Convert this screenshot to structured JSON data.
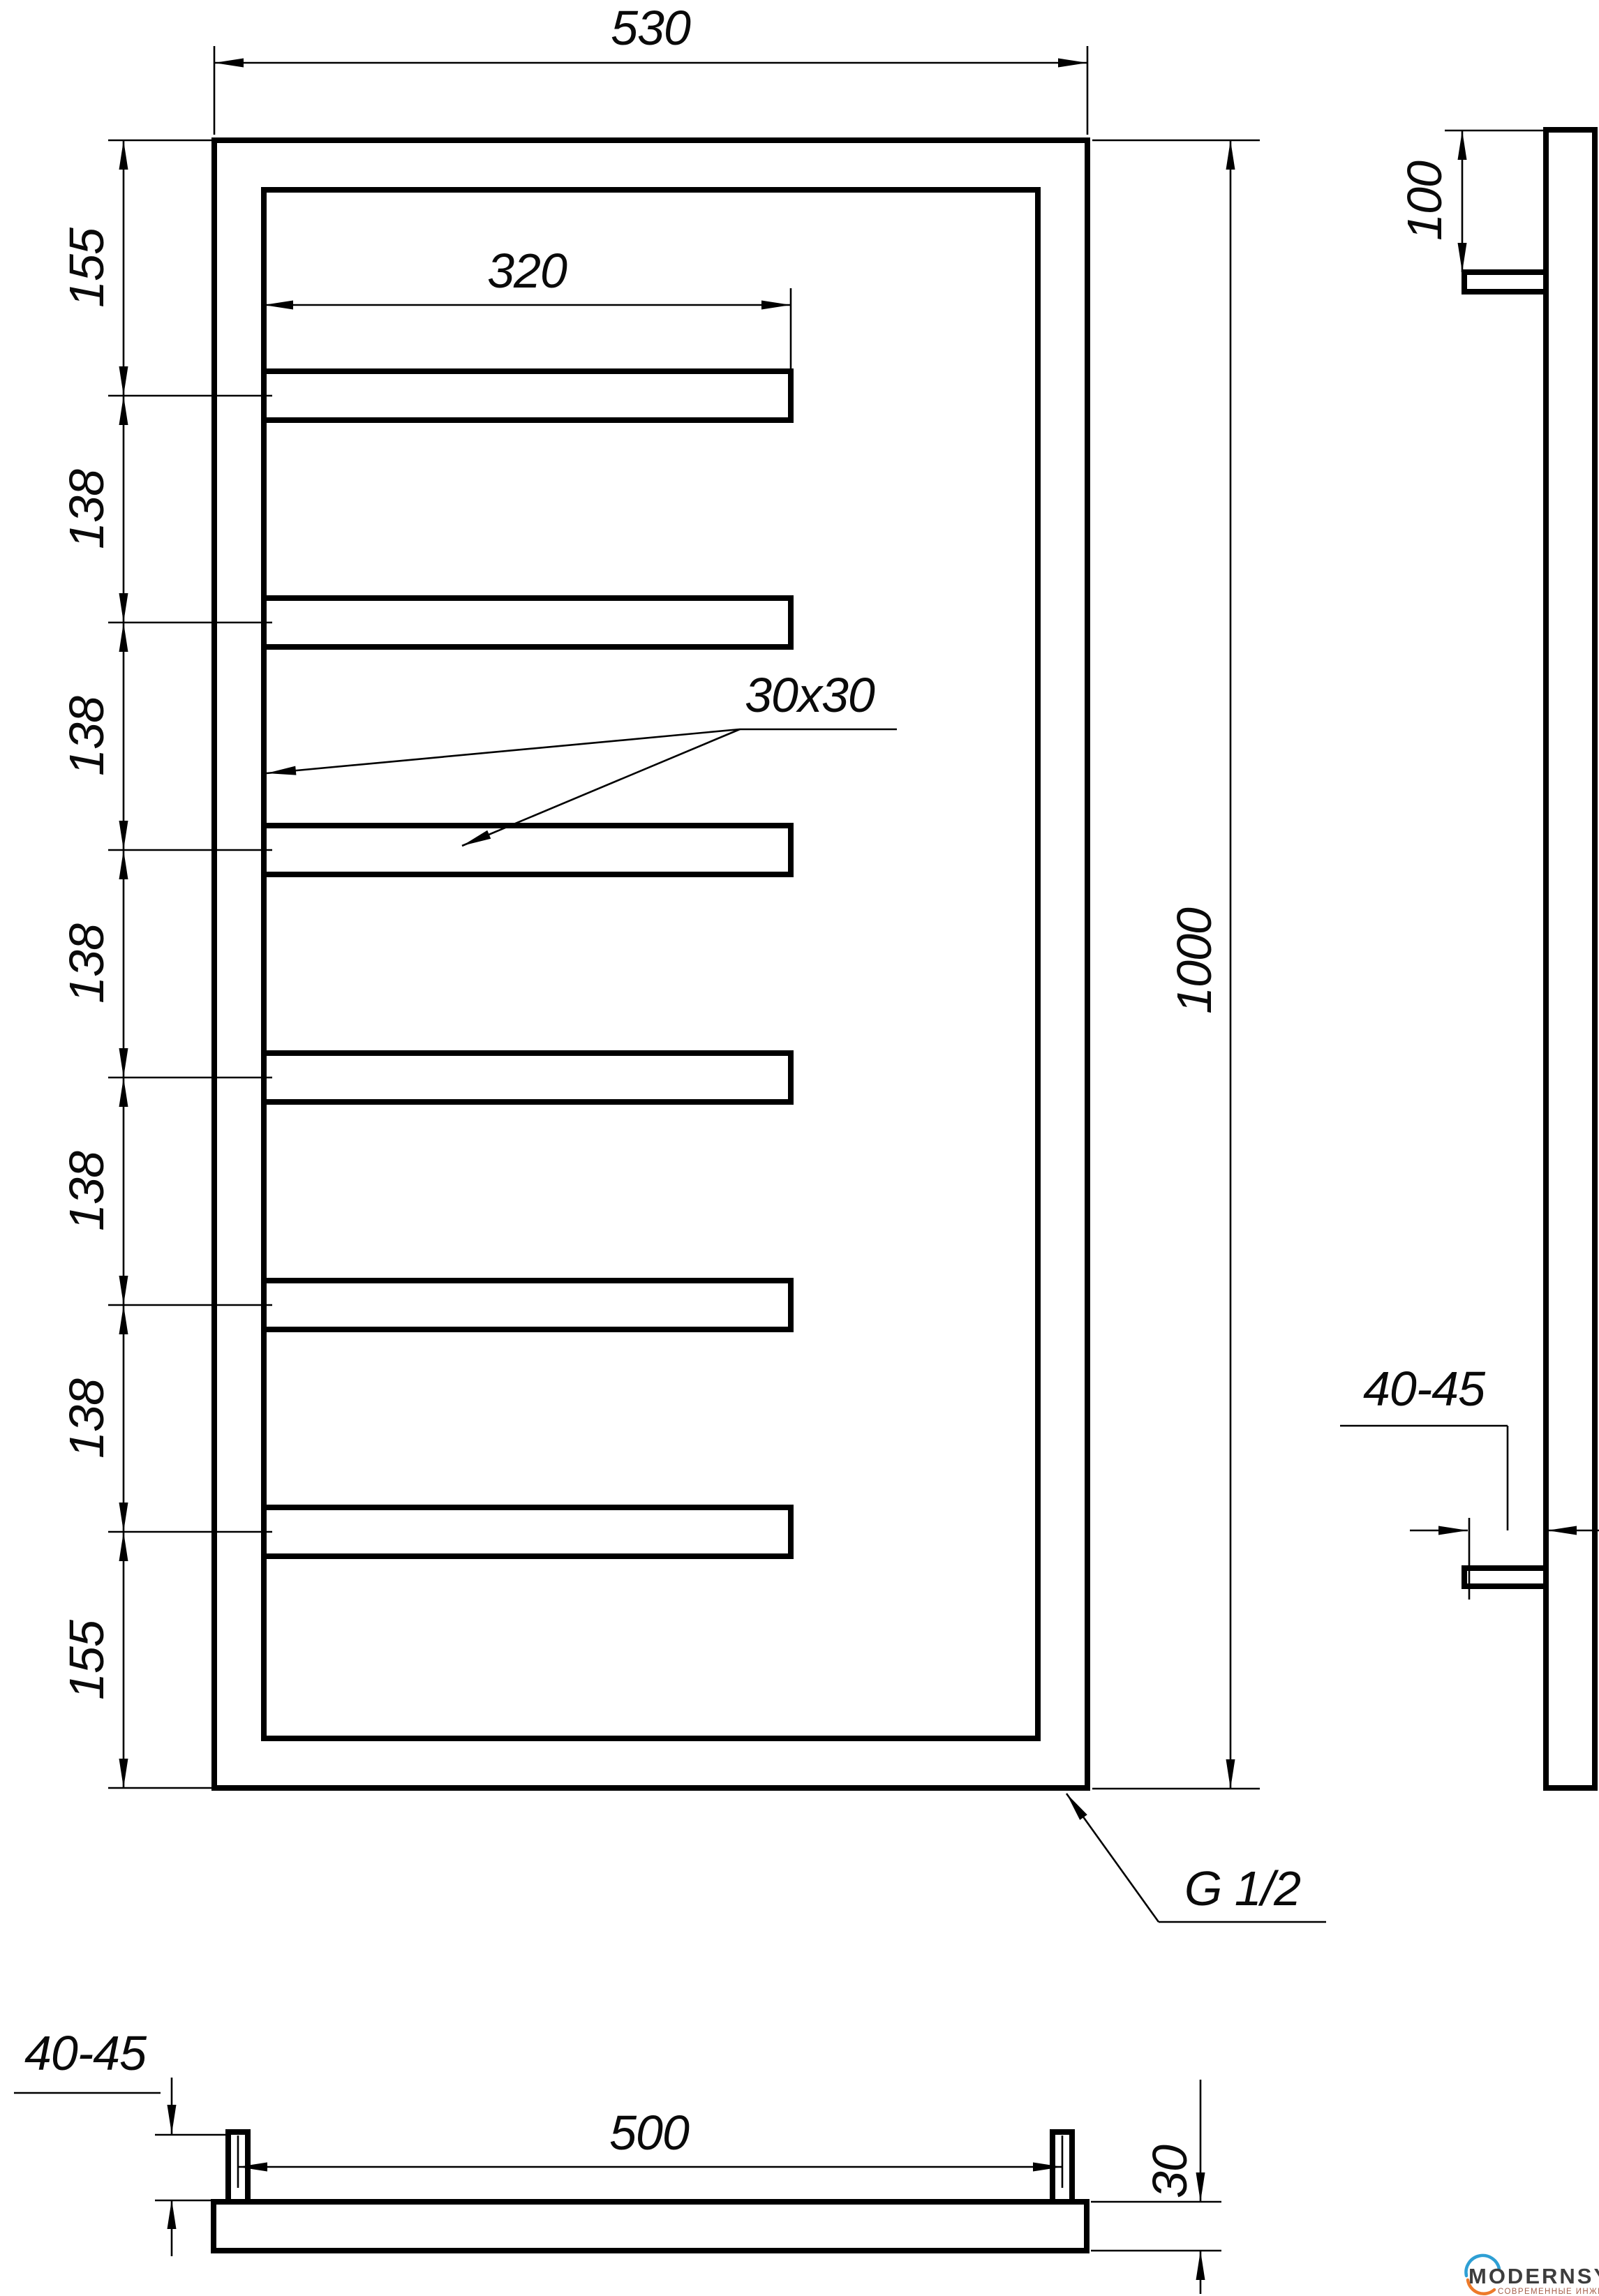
{
  "front_view": {
    "width": "530",
    "slot_width": "320",
    "tube_section": "30x30",
    "height": "1000",
    "left_chain": [
      "155",
      "138",
      "138",
      "138",
      "138",
      "138",
      "155"
    ],
    "thread": "G 1/2"
  },
  "side_view": {
    "top_offset": "100",
    "wall_distance": "40-45"
  },
  "bottom_view": {
    "wall_distance": "40-45",
    "mount_spacing": "500",
    "depth": "30"
  },
  "logo": {
    "brand": "MODERNSYS",
    "tagline": "СОВРЕМЕННЫЕ ИНЖЕНЕРНЫЕ СИСТЕМЫ"
  },
  "colors": {
    "line": "#000000",
    "background": "#ffffff",
    "logo_blue": "#2e9fd4",
    "logo_orange": "#ed7a2a",
    "logo_text": "#3d3d3d",
    "logo_tagline": "#a5604b"
  }
}
